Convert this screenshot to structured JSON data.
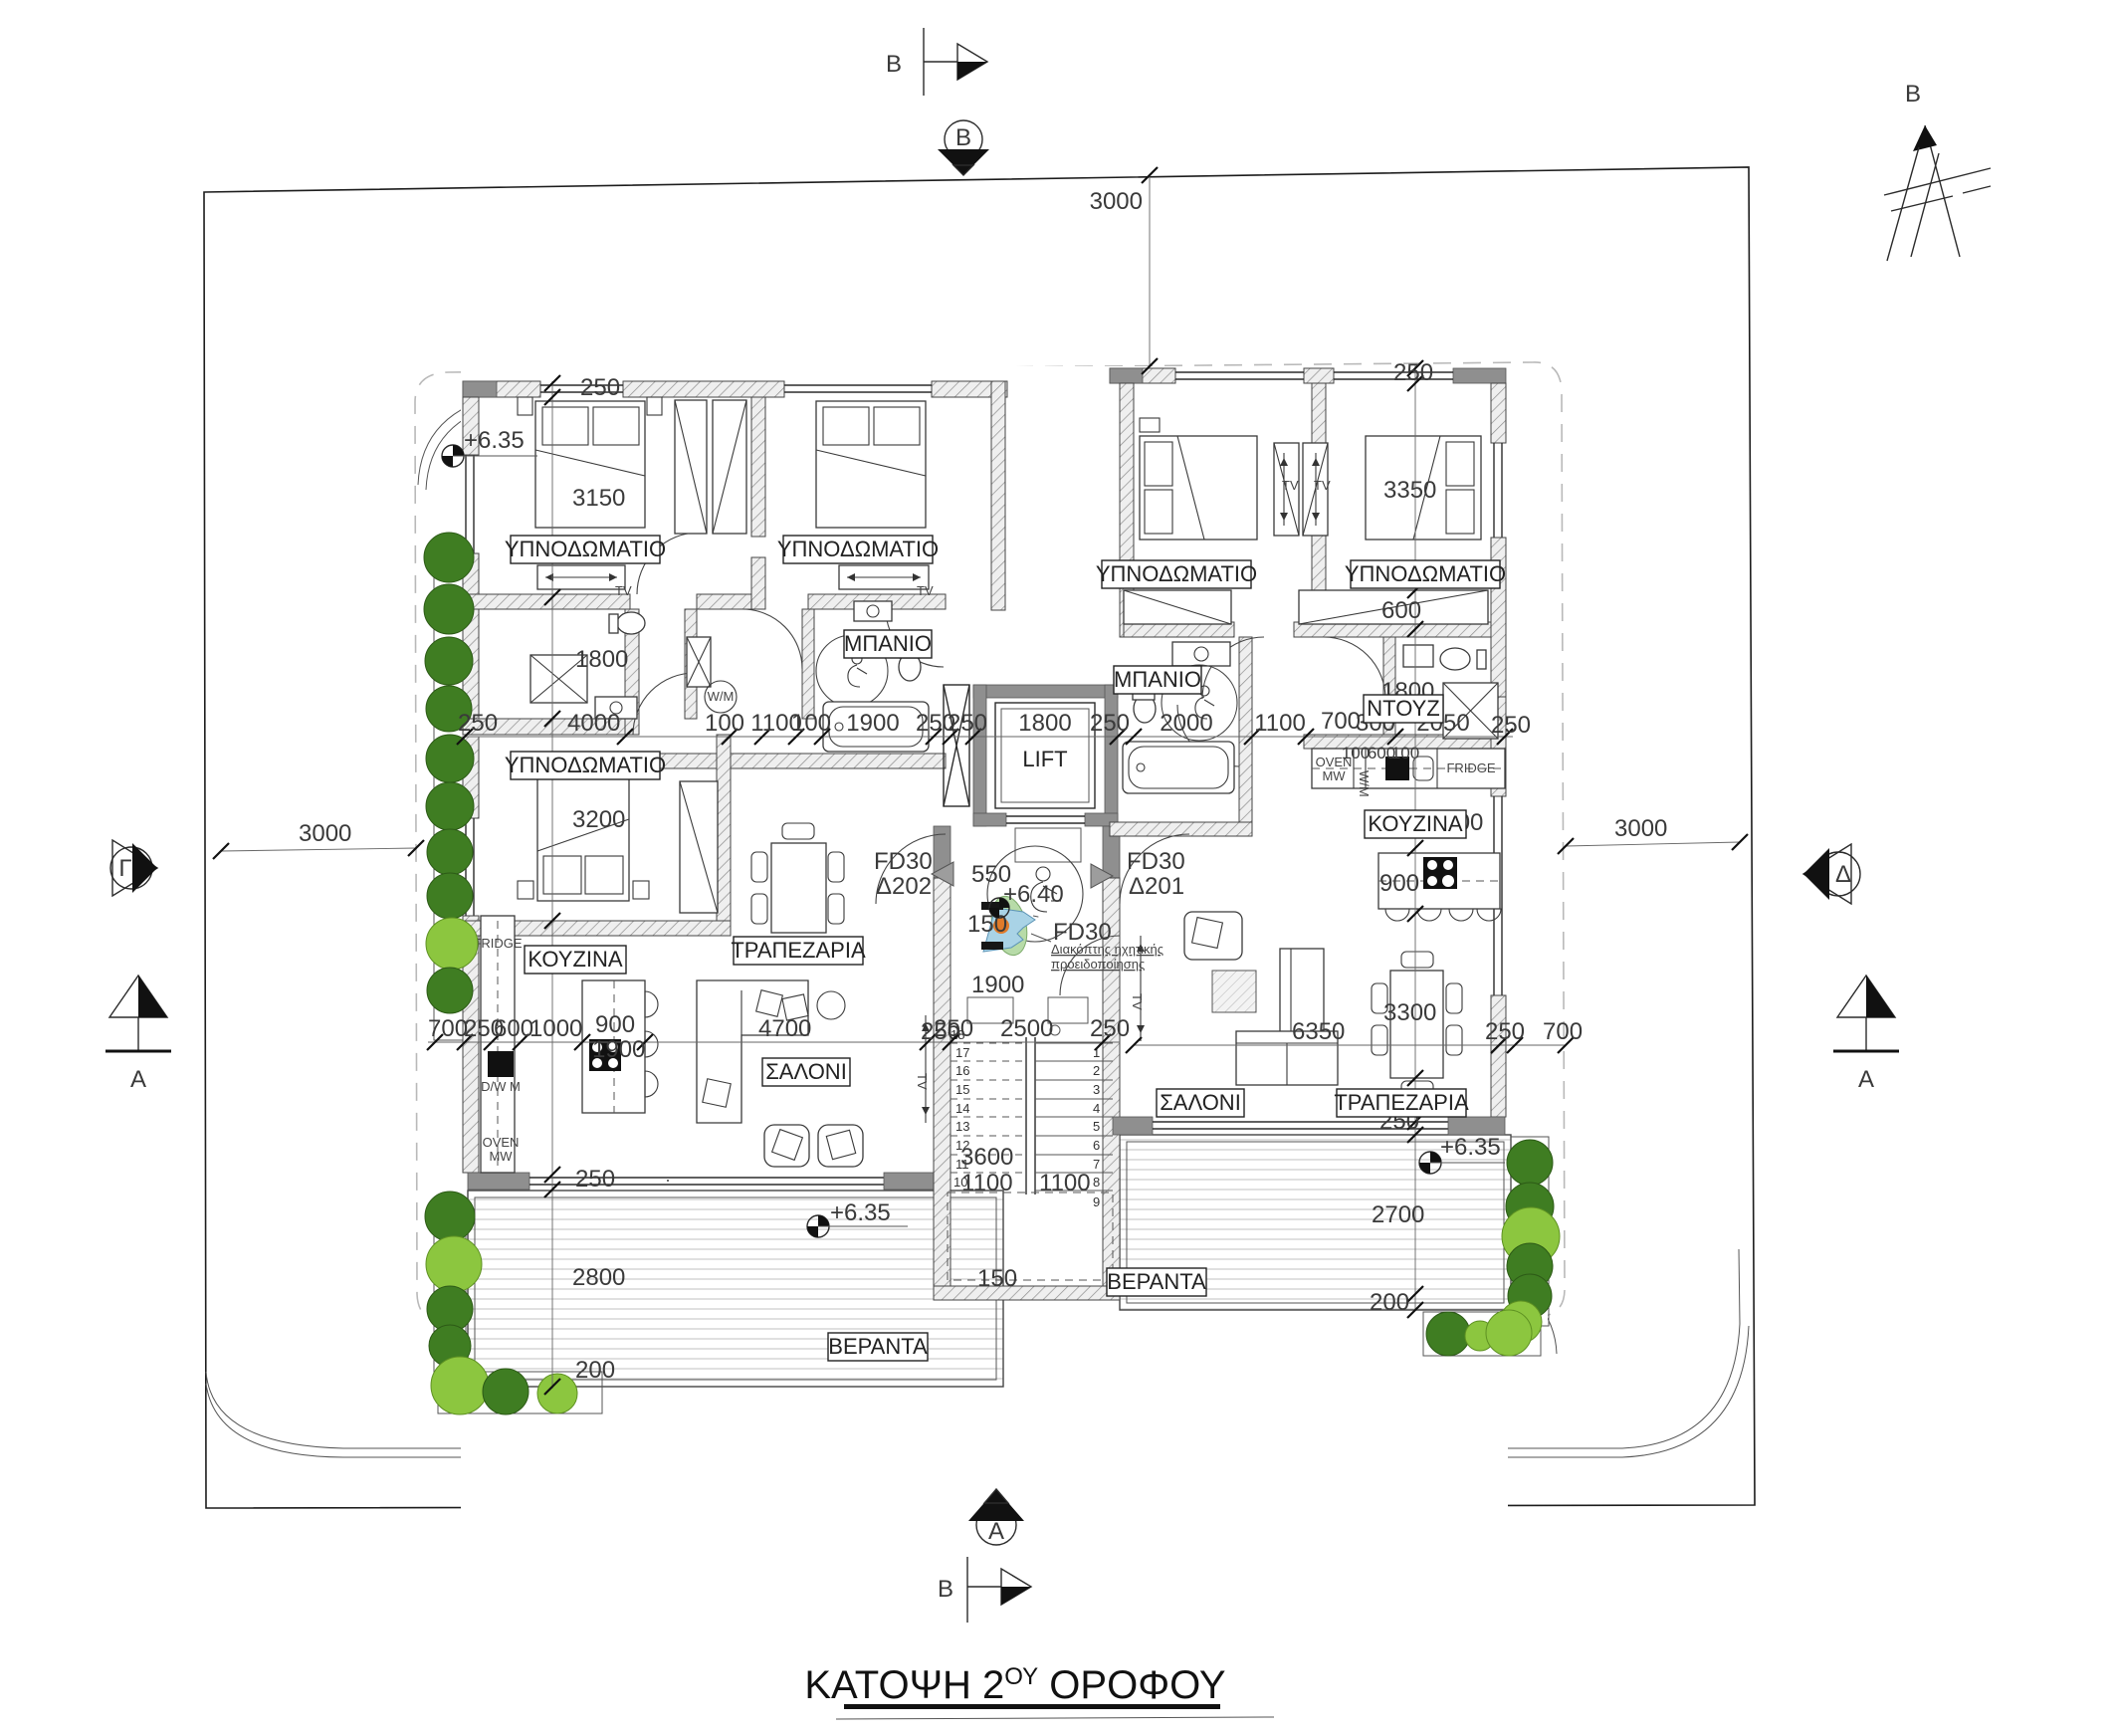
{
  "title": {
    "main": "ΚΑΤΟΨΗ 2",
    "sup": "ΟΥ",
    "rest": " ΟΡΟΦΟΥ"
  },
  "north": {
    "label": "Β"
  },
  "markers": {
    "b_top": "B",
    "b_bottom": "B",
    "circle_b": "B",
    "circle_a": "A",
    "gamma_left": "Γ",
    "a_left": "A",
    "delta_right": "Δ",
    "a_right": "A"
  },
  "levels": {
    "bed_left": "+6.35",
    "hall": "+6.40",
    "veranda_left": "+6.35",
    "veranda_right": "+6.35"
  },
  "rooms": {
    "bedroom1": "ΥΠΝΟΔΩΜΑΤΙΟ",
    "bedroom2": "ΥΠΝΟΔΩΜΑΤΙΟ",
    "bedroom3": "ΥΠΝΟΔΩΜΑΤΙΟ",
    "bedroom4": "ΥΠΝΟΔΩΜΑΤΙΟ",
    "bedroom5": "ΥΠΝΟΔΩΜΑΤΙΟ",
    "bath_left": "ΜΠΑΝΙΟ",
    "bath_right": "ΜΠΑΝΙΟ",
    "shower_right": "ΝΤΟΥΖ",
    "kitchen_left": "ΚΟΥΖΙΝΑ",
    "kitchen_right": "ΚΟΥΖΙΝΑ",
    "dining_left": "ΤΡΑΠΕΖΑΡΙΑ",
    "dining_right": "ΤΡΑΠΕΖΑΡΙΑ",
    "living_left": "ΣΑΛΟΝΙ",
    "living_right": "ΣΑΛΟΝΙ",
    "veranda_left": "ΒΕΡΑΝΤΑ",
    "veranda_right": "ΒΕΡΑΝΤΑ",
    "lift": "LIFT"
  },
  "appliances": {
    "fridge_left": "FRIDGE",
    "fridge_right": "FRIDGE",
    "oven_left": "OVEN",
    "mw_left": "MW",
    "oven_right": "OVEN",
    "mw_right": "MW",
    "dwm": "D/W M",
    "wm": "W/M",
    "tv1": "TV",
    "tv2": "TV",
    "tv3": "TV",
    "tv4": "TV",
    "tv5": "TV",
    "tv6": "TV"
  },
  "doors": {
    "fd30_left": "FD30",
    "d202": "Δ202",
    "fd30_right": "FD30",
    "d201": "Δ201",
    "fd30_mid": "FD30"
  },
  "note": {
    "line1": "Διακόπτης ηχητικής",
    "line2": "προειδοποίησης"
  },
  "dims": {
    "top_3000": "3000",
    "left_3000": "3000",
    "right_3000": "3000",
    "tl_250": "250",
    "tr_250": "250",
    "v_3150": "3150",
    "v_1800": "1800",
    "v_3200": "3200",
    "v_250_ver": "250",
    "v_2800": "2800",
    "v_200": "200",
    "c_250a": "250",
    "c_4000": "4000",
    "c_100a": "100",
    "c_1100a": "1100",
    "c_100b": "100",
    "c_1900": "1900",
    "c_250b": "250",
    "c_250c": "250",
    "c_1800_lift": "1800",
    "c_250d": "250",
    "c_2000": "2000",
    "c_1100b": "1100",
    "c_700": "700",
    "c_300": "300",
    "c_100c": "100",
    "c_600c": "600",
    "c_100d": "100",
    "c_2050": "2050",
    "c_250e": "250",
    "v_3350": "3350",
    "v_600": "600",
    "ntouz_1800": "1800",
    "r_1000": "1000",
    "r_900": "900",
    "r_3300": "3300",
    "r_250v": "250",
    "r_2700": "2700",
    "r_200": "200",
    "l_700": "700",
    "l_250": "250",
    "l_600": "600",
    "l_1000": "1000",
    "l_900": "900",
    "l_1900": "1900",
    "l_4700": "4700",
    "l_250b": "250",
    "s_2500": "2500",
    "s_250l": "250",
    "s_250r": "250",
    "s_3600": "3600",
    "s_1100a": "1100",
    "s_1100b": "1100",
    "s_150": "150",
    "hall_550": "550",
    "hall_150": "150",
    "hall_1900": "1900",
    "r_250_700a": "250",
    "r_250_700b": "700",
    "r_6350": "6350"
  },
  "stairs": [
    "1",
    "2",
    "3",
    "4",
    "5",
    "6",
    "7",
    "8",
    "9",
    "10",
    "11",
    "12",
    "13",
    "14",
    "15",
    "16",
    "17",
    "18"
  ]
}
